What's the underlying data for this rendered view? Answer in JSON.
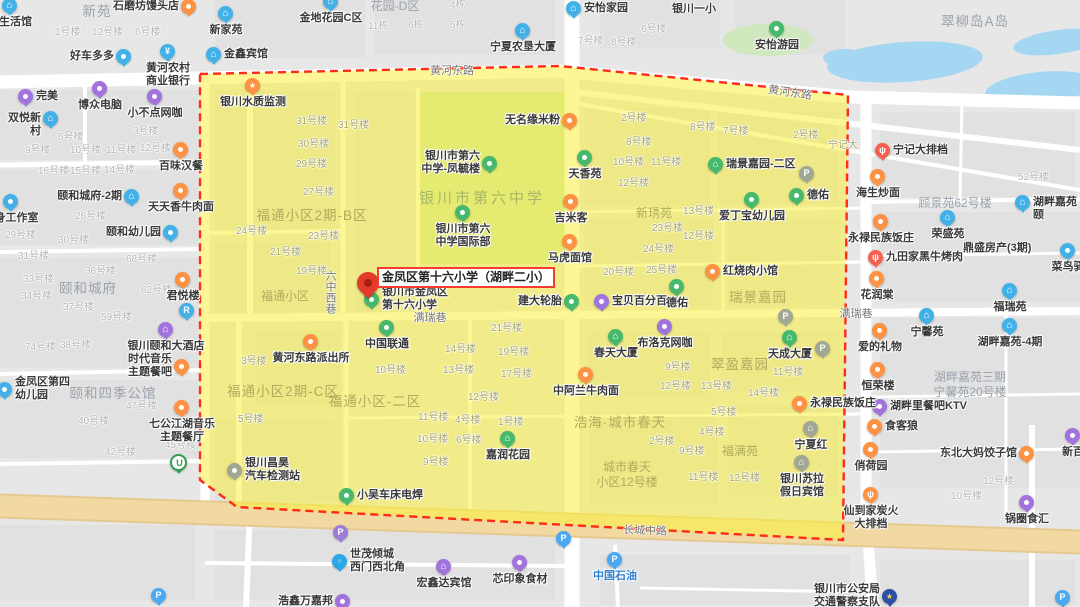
{
  "map": {
    "marker": {
      "label": "金凤区第十六小学（湖畔二小）",
      "callout_x": 377,
      "callout_y": 267,
      "pin_tip_x": 368,
      "pin_tip_y": 301
    },
    "colors": {
      "bg": "#e7e7e7",
      "block": "#e1e1e1",
      "road_white": "#ffffff",
      "arterial": "#f2d9a2",
      "arterial_edge": "#e6c98e",
      "overlay": "rgba(250,240,60,0.55)",
      "district_border": "#ff2a1a",
      "water": "#a6d7f2",
      "campus_green": "#cde3b0",
      "park_green": "#cfe8bd",
      "poi_orange": "#ff9142",
      "poi_red": "#f7604e",
      "poi_blue": "#41b1e8",
      "poi_purple": "#a272dd",
      "poi_green": "#47b96c",
      "poi_gray": "#a0a894",
      "parking_blue": "#4aa9f0",
      "parking_purple": "#9d7bd8",
      "metro_green": "#2f9e4f",
      "police_blue": "#2b4fa3",
      "dot_blue": "#2aa7e8",
      "label_dark": "#3a3a3a",
      "label_blue": "#2f7fd1",
      "bldg_gray": "#b4b4b4",
      "bldg_olive": "#a5a470",
      "area_gray": "#9aa2ac",
      "area_olive": "#b1ab5e",
      "school_green": "#a8b765",
      "road_label": "#757575",
      "pin_red": "#e23b2c"
    },
    "road_labels": [
      [
        "黄河东路",
        452,
        71,
        0,
        "h"
      ],
      [
        "黄河东路",
        790,
        93,
        8,
        "h"
      ],
      [
        "长城中路",
        645,
        531,
        2,
        "h"
      ],
      [
        "满瑞巷",
        430,
        318,
        0,
        "h"
      ],
      [
        "满瑞巷",
        856,
        314,
        0,
        "h"
      ],
      [
        "六中西巷",
        331,
        292,
        0,
        "v"
      ]
    ],
    "areas": [
      [
        "新苑",
        97,
        12,
        "G"
      ],
      [
        "花园-D区",
        395,
        7,
        "g"
      ],
      [
        "翠柳岛A岛",
        975,
        22,
        "G"
      ],
      [
        "颐和城府",
        88,
        289,
        "G"
      ],
      [
        "颐和四季公馆",
        113,
        394,
        "G"
      ],
      [
        "顾景苑62号楼",
        955,
        204,
        "g"
      ],
      [
        "湖畔嘉苑三期\n宁馨苑20号楼",
        970,
        386,
        "g"
      ],
      [
        "福通小区2期-B区",
        312,
        216,
        "Y"
      ],
      [
        "福通小区",
        285,
        297,
        "y"
      ],
      [
        "福通小区2期-C区",
        283,
        392,
        "Y"
      ],
      [
        "福通小区-二区",
        375,
        402,
        "Y"
      ],
      [
        "新琇苑",
        654,
        214,
        "y"
      ],
      [
        "瑞景嘉园",
        758,
        298,
        "Y"
      ],
      [
        "翠盈嘉园",
        740,
        365,
        "Y"
      ],
      [
        "浩海·城市春天",
        620,
        423,
        "Y"
      ],
      [
        "福满苑",
        740,
        452,
        "y"
      ],
      [
        "城市春天\n小区12号楼",
        627,
        476,
        "y"
      ],
      [
        "银川市第六中学",
        482,
        198,
        "s"
      ]
    ],
    "buildings": [
      [
        "1号楼",
        55,
        33,
        "g"
      ],
      [
        "12号楼",
        92,
        33,
        "g"
      ],
      [
        "6号楼",
        135,
        33,
        "g"
      ],
      [
        "4栋",
        450,
        6,
        "g"
      ],
      [
        "11栋",
        368,
        27,
        "g"
      ],
      [
        "6栋",
        408,
        26,
        "g"
      ],
      [
        "5栋",
        450,
        26,
        "g"
      ],
      [
        "7号楼",
        578,
        42,
        "g"
      ],
      [
        "8号楼",
        611,
        43,
        "g"
      ],
      [
        "6号楼",
        641,
        30,
        "g"
      ],
      [
        "银川一小",
        672,
        9,
        "d"
      ],
      [
        "鼎盛房产(3期)",
        963,
        248,
        "d"
      ],
      [
        "5号楼",
        58,
        138,
        "g"
      ],
      [
        "3号楼",
        133,
        132,
        "g"
      ],
      [
        "9号楼",
        25,
        151,
        "g"
      ],
      [
        "10号楼",
        70,
        151,
        "g"
      ],
      [
        "11号楼",
        106,
        151,
        "g"
      ],
      [
        "12号楼",
        140,
        149,
        "g"
      ],
      [
        "16号楼",
        38,
        172,
        "g"
      ],
      [
        "15号楼",
        70,
        172,
        "g"
      ],
      [
        "14号楼",
        104,
        171,
        "g"
      ],
      [
        "26号楼",
        75,
        217,
        "g"
      ],
      [
        "29号楼",
        5,
        236,
        "g"
      ],
      [
        "30号楼",
        58,
        241,
        "g"
      ],
      [
        "31号楼",
        18,
        257,
        "g"
      ],
      [
        "33号楼",
        23,
        280,
        "g"
      ],
      [
        "34号楼",
        21,
        297,
        "g"
      ],
      [
        "36号楼",
        85,
        272,
        "g"
      ],
      [
        "68号楼",
        126,
        260,
        "g"
      ],
      [
        "62号楼",
        141,
        291,
        "g"
      ],
      [
        "37号楼",
        63,
        308,
        "g"
      ],
      [
        "59号楼",
        101,
        318,
        "g"
      ],
      [
        "74号楼",
        25,
        348,
        "g"
      ],
      [
        "38号楼",
        60,
        346,
        "g"
      ],
      [
        "47号楼",
        126,
        407,
        "g"
      ],
      [
        "40号楼",
        78,
        422,
        "g"
      ],
      [
        "42号楼",
        105,
        453,
        "g"
      ],
      [
        "45号楼",
        165,
        446,
        "g"
      ],
      [
        "52号楼",
        1018,
        178,
        "g"
      ],
      [
        "12号楼",
        983,
        482,
        "g"
      ],
      [
        "10号楼",
        951,
        497,
        "g"
      ],
      [
        "31号楼",
        296,
        122,
        "y"
      ],
      [
        "31号楼",
        338,
        126,
        "y"
      ],
      [
        "30号楼",
        298,
        145,
        "y"
      ],
      [
        "29号楼",
        296,
        165,
        "y"
      ],
      [
        "27号楼",
        303,
        193,
        "y"
      ],
      [
        "24号楼",
        236,
        232,
        "y"
      ],
      [
        "23号楼",
        308,
        237,
        "y"
      ],
      [
        "21号楼",
        270,
        253,
        "y"
      ],
      [
        "19号楼",
        296,
        272,
        "y"
      ],
      [
        "宁记大",
        828,
        146,
        "y"
      ],
      [
        "2号楼",
        621,
        119,
        "y"
      ],
      [
        "8号楼",
        690,
        128,
        "y"
      ],
      [
        "7号楼",
        723,
        132,
        "y"
      ],
      [
        "2号楼",
        793,
        136,
        "y"
      ],
      [
        "8号楼",
        626,
        143,
        "y"
      ],
      [
        "10号楼",
        613,
        163,
        "y"
      ],
      [
        "11号楼",
        651,
        163,
        "y"
      ],
      [
        "12号楼",
        618,
        184,
        "y"
      ],
      [
        "13号楼",
        683,
        212,
        "y"
      ],
      [
        "23号楼",
        652,
        229,
        "y"
      ],
      [
        "12号楼",
        683,
        237,
        "y"
      ],
      [
        "24号楼",
        643,
        250,
        "y"
      ],
      [
        "20号楼",
        603,
        273,
        "y"
      ],
      [
        "25号楼",
        646,
        271,
        "y"
      ],
      [
        "21号楼",
        491,
        329,
        "y"
      ],
      [
        "14号楼",
        445,
        350,
        "y"
      ],
      [
        "19号楼",
        498,
        353,
        "y"
      ],
      [
        "13号楼",
        443,
        371,
        "y"
      ],
      [
        "17号楼",
        501,
        375,
        "y"
      ],
      [
        "12号楼",
        468,
        398,
        "y"
      ],
      [
        "10号楼",
        375,
        371,
        "y"
      ],
      [
        "3号楼",
        241,
        362,
        "y"
      ],
      [
        "5号楼",
        238,
        420,
        "y"
      ],
      [
        "11号楼",
        418,
        418,
        "y"
      ],
      [
        "4号楼",
        455,
        421,
        "y"
      ],
      [
        "1号楼",
        498,
        423,
        "y"
      ],
      [
        "10号楼",
        417,
        440,
        "y"
      ],
      [
        "6号楼",
        456,
        441,
        "y"
      ],
      [
        "9号楼",
        423,
        463,
        "y"
      ],
      [
        "9号楼",
        665,
        368,
        "y"
      ],
      [
        "11号楼",
        773,
        373,
        "y"
      ],
      [
        "12号楼",
        660,
        387,
        "y"
      ],
      [
        "13号楼",
        701,
        387,
        "y"
      ],
      [
        "14号楼",
        748,
        394,
        "y"
      ],
      [
        "5号楼",
        711,
        413,
        "y"
      ],
      [
        "4号楼",
        699,
        433,
        "y"
      ],
      [
        "2号楼",
        649,
        442,
        "y"
      ],
      [
        "9号楼",
        679,
        452,
        "y"
      ],
      [
        "11号楼",
        688,
        478,
        "y"
      ],
      [
        "12号楼",
        729,
        479,
        "y"
      ]
    ],
    "pois": [
      [
        "艺生活馆",
        10,
        6,
        "bl",
        "⌂",
        "b",
        ""
      ],
      [
        "石磨坊馒头店",
        189,
        7,
        "or",
        "",
        "l",
        ""
      ],
      [
        "新家苑",
        226,
        14,
        "bl",
        "⌂",
        "b",
        ""
      ],
      [
        "金地花园C区",
        331,
        2,
        "bl",
        "⌂",
        "b",
        ""
      ],
      [
        "金鑫宾馆",
        214,
        55,
        "bl",
        "⌂",
        "r",
        ""
      ],
      [
        "好车多多",
        124,
        57,
        "bl",
        "",
        "l",
        ""
      ],
      [
        "黄河农村\n商业银行",
        168,
        52,
        "bl",
        "¥",
        "b",
        ""
      ],
      [
        "完美",
        26,
        97,
        "pu",
        "",
        "r",
        ""
      ],
      [
        "博众电脑",
        100,
        89,
        "pu",
        "",
        "b",
        ""
      ],
      [
        "双悦新村",
        51,
        119,
        "bl",
        "⌂",
        "l",
        ""
      ],
      [
        "小不点网咖",
        155,
        97,
        "pu",
        "",
        "b",
        ""
      ],
      [
        "宁夏农垦大厦",
        523,
        31,
        "bl",
        "⌂",
        "b",
        ""
      ],
      [
        "安怡家园",
        574,
        9,
        "bl",
        "⌂",
        "r",
        ""
      ],
      [
        "安怡游园",
        777,
        29,
        "gn",
        "",
        "b",
        ""
      ],
      [
        "宁记大排档",
        883,
        151,
        "rd",
        "ψ",
        "r",
        ""
      ],
      [
        "海生炒面",
        878,
        177,
        "or",
        "",
        "b",
        ""
      ],
      [
        "永禄民族饭庄",
        881,
        222,
        "or",
        "",
        "b",
        ""
      ],
      [
        "九田家黑牛烤肉",
        876,
        258,
        "rd",
        "ψ",
        "r",
        ""
      ],
      [
        "花润棠",
        877,
        279,
        "or",
        "",
        "b",
        ""
      ],
      [
        "湖畔嘉苑颐",
        1023,
        203,
        "bl",
        "⌂",
        "r",
        ""
      ],
      [
        "荣盛苑",
        948,
        218,
        "bl",
        "⌂",
        "b",
        ""
      ],
      [
        "菜鸟驿",
        1068,
        251,
        "bl",
        "",
        "b",
        ""
      ],
      [
        "福瑞苑",
        1010,
        291,
        "bl",
        "⌂",
        "b",
        ""
      ],
      [
        "宁馨苑",
        927,
        316,
        "bl",
        "⌂",
        "b",
        ""
      ],
      [
        "湖畔嘉苑-4期",
        1010,
        326,
        "bl",
        "⌂",
        "b",
        ""
      ],
      [
        "爱的礼物",
        880,
        331,
        "or",
        "",
        "b",
        ""
      ],
      [
        "恒荣楼",
        878,
        370,
        "or",
        "",
        "b",
        ""
      ],
      [
        "湖畔里餐吧KTV",
        880,
        407,
        "pu",
        "",
        "r",
        ""
      ],
      [
        "食客狼",
        875,
        427,
        "or",
        "",
        "r",
        ""
      ],
      [
        "俏荷园",
        871,
        450,
        "or",
        "",
        "b",
        ""
      ],
      [
        "东北大妈饺子馆",
        1027,
        454,
        "or",
        "",
        "l",
        ""
      ],
      [
        "新百",
        1073,
        436,
        "pu",
        "",
        "b",
        ""
      ],
      [
        "仙到家炭火\n大排档",
        871,
        495,
        "or",
        "ψ",
        "b",
        ""
      ],
      [
        "锅圈食汇",
        1027,
        503,
        "pu",
        "",
        "b",
        ""
      ],
      [
        "银川市公安局\n交通警察支队",
        890,
        597,
        "po",
        "★",
        "l",
        ""
      ],
      [
        "",
        1063,
        598,
        "pb",
        "P",
        "b",
        ""
      ],
      [
        "中国石油",
        615,
        560,
        "pb",
        "P",
        "b",
        "b"
      ],
      [
        "",
        564,
        539,
        "pb",
        "P",
        "b",
        ""
      ],
      [
        "",
        341,
        533,
        "pp",
        "P",
        "b",
        ""
      ],
      [
        "世茂倾城\n西门西北角",
        340,
        562,
        "db",
        "○",
        "r",
        ""
      ],
      [
        "宏鑫达宾馆",
        444,
        567,
        "pu",
        "⌂",
        "b",
        ""
      ],
      [
        "芯印象食材",
        520,
        563,
        "pu",
        "",
        "b",
        ""
      ],
      [
        "浩鑫万嘉邦",
        343,
        602,
        "pu",
        "",
        "l",
        ""
      ],
      [
        "",
        159,
        596,
        "pb",
        "P",
        "b",
        ""
      ],
      [
        "百味汉餐",
        181,
        150,
        "or",
        "",
        "b",
        ""
      ],
      [
        "天天香牛肉面",
        181,
        191,
        "or",
        "",
        "b",
        ""
      ],
      [
        "颐和城府-2期",
        132,
        197,
        "bl",
        "⌂",
        "l",
        ""
      ],
      [
        "健身工作室",
        11,
        202,
        "bl",
        "",
        "b",
        ""
      ],
      [
        "颐和幼儿园",
        171,
        233,
        "bl",
        "",
        "l",
        ""
      ],
      [
        "君悦楼",
        183,
        280,
        "or",
        "",
        "b",
        ""
      ],
      [
        "银川颐和大酒店",
        166,
        330,
        "pu",
        "⌂",
        "b",
        ""
      ],
      [
        "时代音乐\n主题餐吧",
        182,
        367,
        "or",
        "",
        "l",
        ""
      ],
      [
        "金凤区第四\n幼儿园",
        5,
        390,
        "bl",
        "",
        "r",
        ""
      ],
      [
        "七公江湖音乐\n主题餐厅",
        182,
        408,
        "or",
        "",
        "b",
        ""
      ],
      [
        "银川水质监测",
        253,
        86,
        "or",
        "★",
        "b",
        ""
      ],
      [
        "",
        178,
        462,
        "mt",
        "U",
        "b",
        ""
      ],
      [
        "",
        187,
        311,
        "bl",
        "R",
        "b",
        ""
      ],
      [
        "无名缘米粉",
        570,
        121,
        "or",
        "",
        "l",
        ""
      ],
      [
        "天香苑",
        585,
        158,
        "gn",
        "",
        "b",
        ""
      ],
      [
        "瑞景嘉园-二区",
        716,
        165,
        "gn",
        "⌂",
        "r",
        ""
      ],
      [
        "德佑",
        797,
        196,
        "gn",
        "",
        "r",
        ""
      ],
      [
        "吉米客",
        571,
        202,
        "or",
        "",
        "b",
        ""
      ],
      [
        "爱丁宝幼儿园",
        752,
        200,
        "gn",
        "",
        "b",
        ""
      ],
      [
        "马虎面馆",
        570,
        242,
        "or",
        "",
        "b",
        ""
      ],
      [
        "红烧肉小馆",
        713,
        272,
        "or",
        "",
        "r",
        ""
      ],
      [
        "建大轮胎",
        572,
        302,
        "gn",
        "",
        "l",
        ""
      ],
      [
        "宝贝百分百",
        602,
        302,
        "pu",
        "",
        "r",
        ""
      ],
      [
        "德佑",
        677,
        287,
        "gn",
        "",
        "b",
        ""
      ],
      [
        "布洛克网咖",
        665,
        327,
        "pu",
        "",
        "b",
        ""
      ],
      [
        "春天大厦",
        616,
        337,
        "gn",
        "⌂",
        "b",
        ""
      ],
      [
        "天成大厦",
        790,
        338,
        "gn",
        "⌂",
        "b",
        ""
      ],
      [
        "中阿兰牛肉面",
        586,
        375,
        "or",
        "",
        "b",
        ""
      ],
      [
        "永禄民族饭庄",
        800,
        404,
        "or",
        "",
        "r",
        ""
      ],
      [
        "宁夏红",
        811,
        429,
        "gy",
        "⌂",
        "b",
        ""
      ],
      [
        "银川苏拉\n假日宾馆",
        802,
        463,
        "gy",
        "⌂",
        "b",
        ""
      ],
      [
        "嘉润花园",
        508,
        439,
        "gn",
        "⌂",
        "b",
        ""
      ],
      [
        "银川昌昊\n汽车检测站",
        235,
        471,
        "gy",
        "",
        "r",
        ""
      ],
      [
        "小吴车床电焊",
        347,
        496,
        "gn",
        "",
        "r",
        ""
      ],
      [
        "黄河东路派出所",
        311,
        342,
        "or",
        "",
        "b",
        ""
      ],
      [
        "中国联通",
        387,
        328,
        "gn",
        "",
        "b",
        ""
      ],
      [
        "银川市第六\n中学-凤毓楼",
        490,
        164,
        "gn",
        "",
        "l",
        ""
      ],
      [
        "银川市第六\n中学国际部",
        463,
        213,
        "gn",
        "",
        "b",
        ""
      ],
      [
        "银川市金凤区\n第十六小学",
        372,
        300,
        "gn",
        "",
        "r",
        ""
      ],
      [
        "",
        807,
        174,
        "pg",
        "P",
        "b",
        ""
      ],
      [
        "",
        786,
        317,
        "pg",
        "P",
        "b",
        ""
      ],
      [
        "",
        823,
        349,
        "pg",
        "P",
        "b",
        ""
      ]
    ]
  }
}
